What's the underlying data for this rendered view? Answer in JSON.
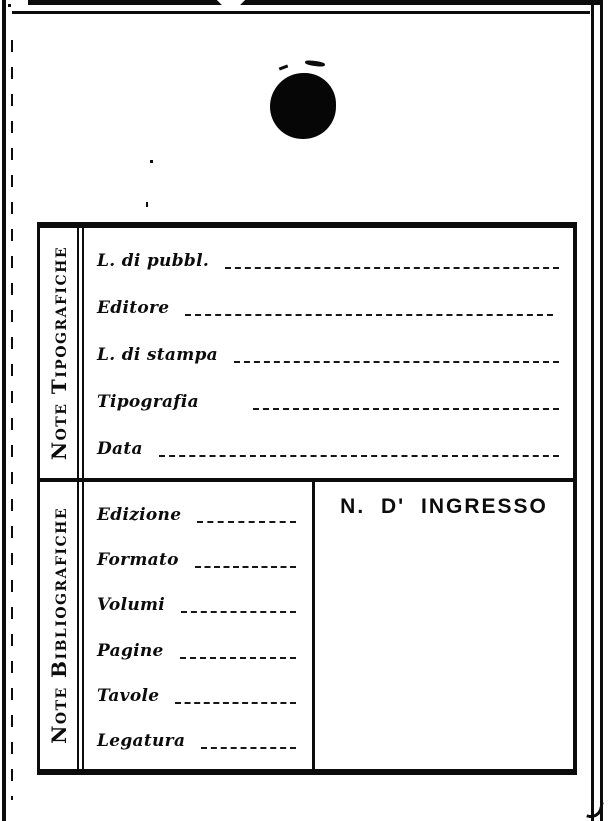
{
  "card": {
    "colors": {
      "ink": "#0c0c0c",
      "paper": "#ffffff"
    },
    "sections": [
      {
        "title": "Note Tipografiche",
        "fields": [
          {
            "label": "L. di pubbl.",
            "value": ""
          },
          {
            "label": "Editore",
            "value": ""
          },
          {
            "label": "L. di stampa",
            "value": ""
          },
          {
            "label": "Tipografia",
            "value": ""
          },
          {
            "label": "Data",
            "value": ""
          }
        ]
      },
      {
        "title": "Note Bibliografiche",
        "fields": [
          {
            "label": "Edizione",
            "value": ""
          },
          {
            "label": "Formato",
            "value": ""
          },
          {
            "label": "Volumi",
            "value": ""
          },
          {
            "label": "Pagine",
            "value": ""
          },
          {
            "label": "Tavole",
            "value": ""
          },
          {
            "label": "Legatura",
            "value": ""
          }
        ],
        "ingresso": {
          "label": "N. D' INGRESSO",
          "value": ""
        }
      }
    ]
  }
}
